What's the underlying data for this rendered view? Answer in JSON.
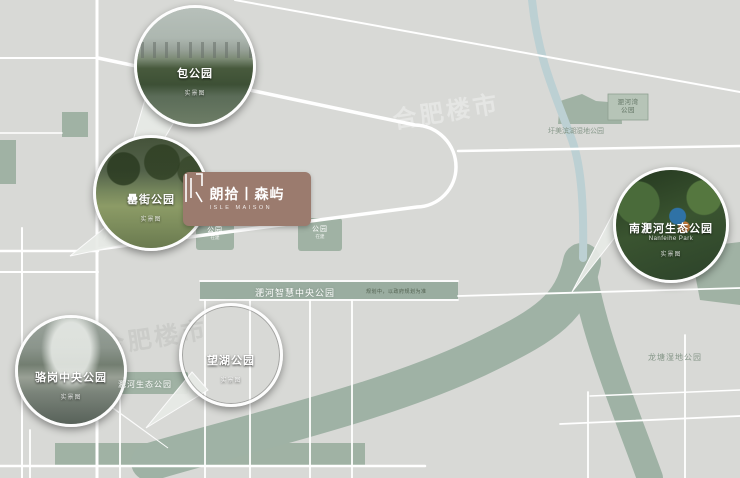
{
  "map": {
    "watermark": "合肥楼市",
    "colors": {
      "background": "#d8d9d6",
      "road": "#ffffff",
      "greenspace": "#a0b2a4",
      "river": "#9fb2a5",
      "stream": "#bcd0d3",
      "logo_bg": "#9b7b6e"
    }
  },
  "logo_card": {
    "name_cn": "朗拾丨森屿",
    "name_en": "ISLE MAISON"
  },
  "callouts": [
    {
      "label": "包公园",
      "sublabel": "实景图"
    },
    {
      "label": "罍街公园",
      "sublabel": "实景图"
    },
    {
      "label": "骆岗中央公园",
      "sublabel": "实景图"
    },
    {
      "label": "望湖公园",
      "sublabel": "实景图"
    },
    {
      "label": "南淝河生态公园",
      "sublabel_en": "Nanfeihe Park",
      "sublabel": "实景图"
    }
  ],
  "area_labels": {
    "smart_park": "淝河智慧中央公园",
    "smart_park_note": "规划中，以政府规划为准",
    "eco_park": "淝河生态公园",
    "longtang": "龙塘湿地公园",
    "weimei": "圩美滨湖湿地公园",
    "feihewan_line1": "淝河湾",
    "feihewan_line2": "公园",
    "patch1": "公园",
    "patch1_note": "在建",
    "patch2": "公园",
    "patch2_note": "在建"
  }
}
